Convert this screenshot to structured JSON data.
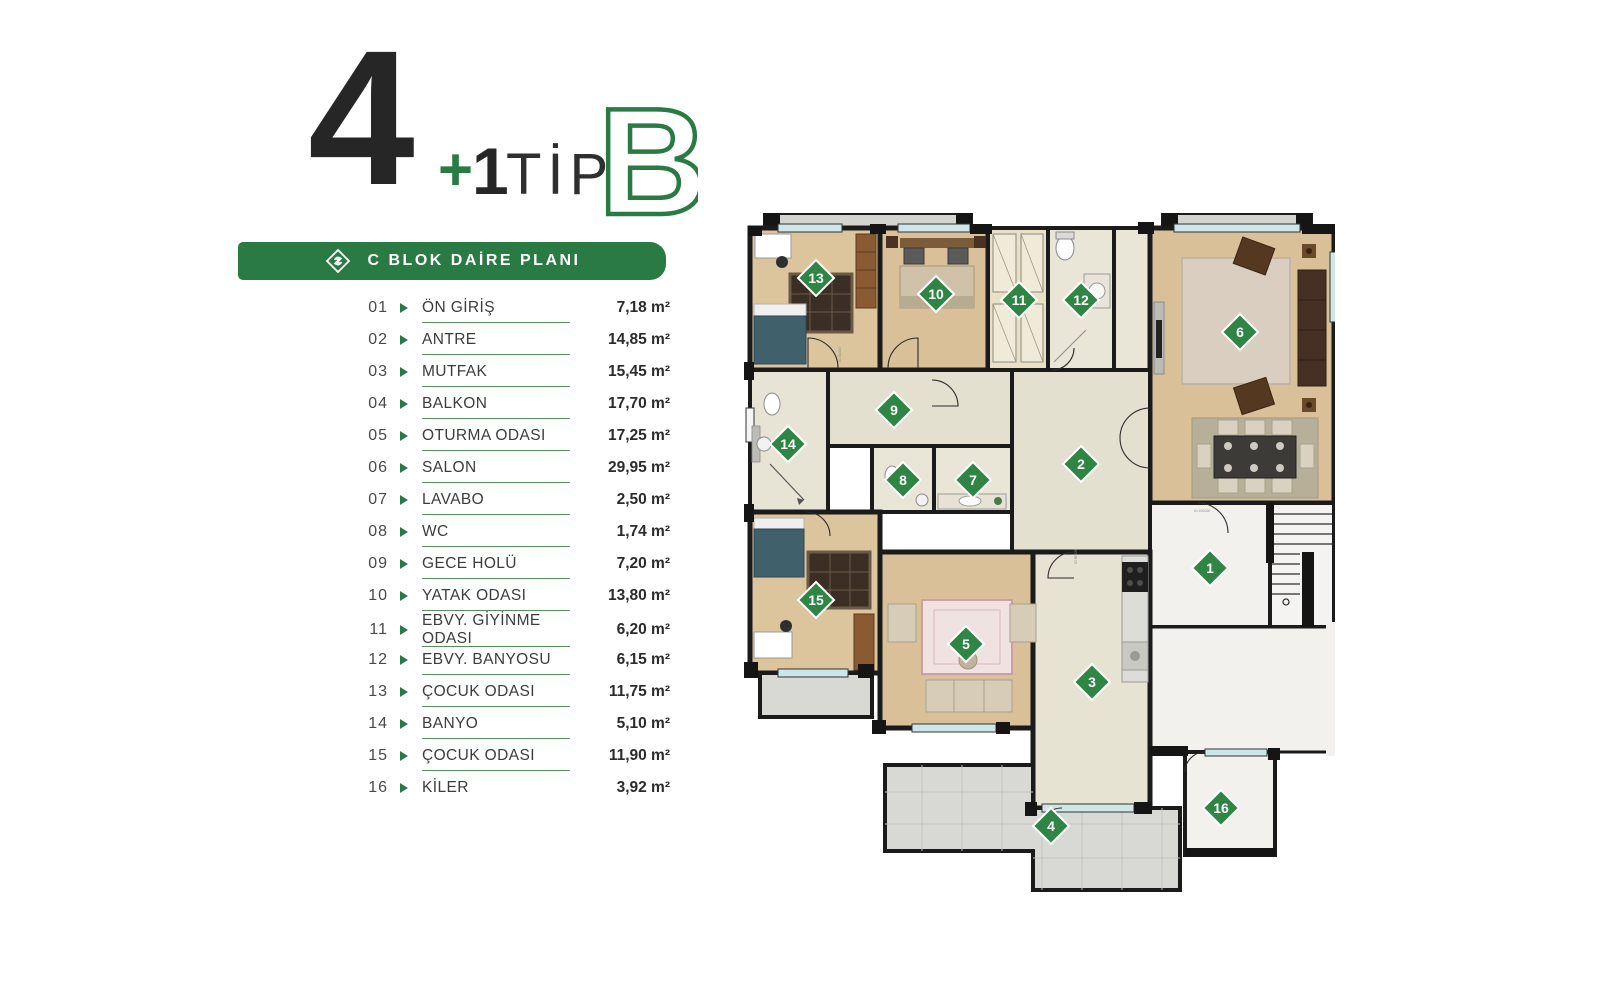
{
  "title": {
    "big_number": "4",
    "plus_sign": "+",
    "after_plus": "1",
    "tip_label": "TİP",
    "type_letter": "B"
  },
  "banner": {
    "logo_icon": "brand-diamond-logo",
    "label": "C BLOK DAİRE PLANI"
  },
  "rooms": [
    {
      "no": "01",
      "name": "ÖN GİRİŞ",
      "area": "7,18 m²"
    },
    {
      "no": "02",
      "name": "ANTRE",
      "area": "14,85 m²"
    },
    {
      "no": "03",
      "name": "MUTFAK",
      "area": "15,45 m²"
    },
    {
      "no": "04",
      "name": "BALKON",
      "area": "17,70 m²"
    },
    {
      "no": "05",
      "name": "OTURMA ODASI",
      "area": "17,25 m²"
    },
    {
      "no": "06",
      "name": "SALON",
      "area": "29,95 m²"
    },
    {
      "no": "07",
      "name": "LAVABO",
      "area": "2,50 m²"
    },
    {
      "no": "08",
      "name": "WC",
      "area": "1,74 m²"
    },
    {
      "no": "09",
      "name": "GECE HOLÜ",
      "area": "7,20 m²"
    },
    {
      "no": "10",
      "name": "YATAK ODASI",
      "area": "13,80 m²"
    },
    {
      "no": "11",
      "name": "EBVY. GİYİNME ODASI",
      "area": "6,20 m²"
    },
    {
      "no": "12",
      "name": "EBVY. BANYOSU",
      "area": "6,15 m²"
    },
    {
      "no": "13",
      "name": "ÇOCUK ODASI",
      "area": "11,75 m²"
    },
    {
      "no": "14",
      "name": "BANYO",
      "area": "5,10 m²"
    },
    {
      "no": "15",
      "name": "ÇOCUK ODASI",
      "area": "11,90 m²"
    },
    {
      "no": "16",
      "name": "KİLER",
      "area": "3,92 m²"
    }
  ],
  "plan": {
    "markers": [
      {
        "n": "1",
        "x": 468,
        "y": 356
      },
      {
        "n": "2",
        "x": 339,
        "y": 252
      },
      {
        "n": "3",
        "x": 350,
        "y": 470
      },
      {
        "n": "4",
        "x": 309,
        "y": 614
      },
      {
        "n": "5",
        "x": 224,
        "y": 432
      },
      {
        "n": "6",
        "x": 498,
        "y": 120
      },
      {
        "n": "7",
        "x": 231,
        "y": 268
      },
      {
        "n": "8",
        "x": 161,
        "y": 268
      },
      {
        "n": "9",
        "x": 152,
        "y": 198
      },
      {
        "n": "10",
        "x": 194,
        "y": 82
      },
      {
        "n": "11",
        "x": 277,
        "y": 88
      },
      {
        "n": "12",
        "x": 339,
        "y": 88
      },
      {
        "n": "13",
        "x": 74,
        "y": 66
      },
      {
        "n": "14",
        "x": 46,
        "y": 232
      },
      {
        "n": "15",
        "x": 74,
        "y": 388
      },
      {
        "n": "16",
        "x": 479,
        "y": 596
      }
    ],
    "door_labels": [
      "K1 90/220",
      "K2 80/220",
      "K1 100/220"
    ]
  },
  "colors": {
    "accent_green": "#2a7a44",
    "marker_green": "#2e8544",
    "underline_green": "#55925f"
  }
}
